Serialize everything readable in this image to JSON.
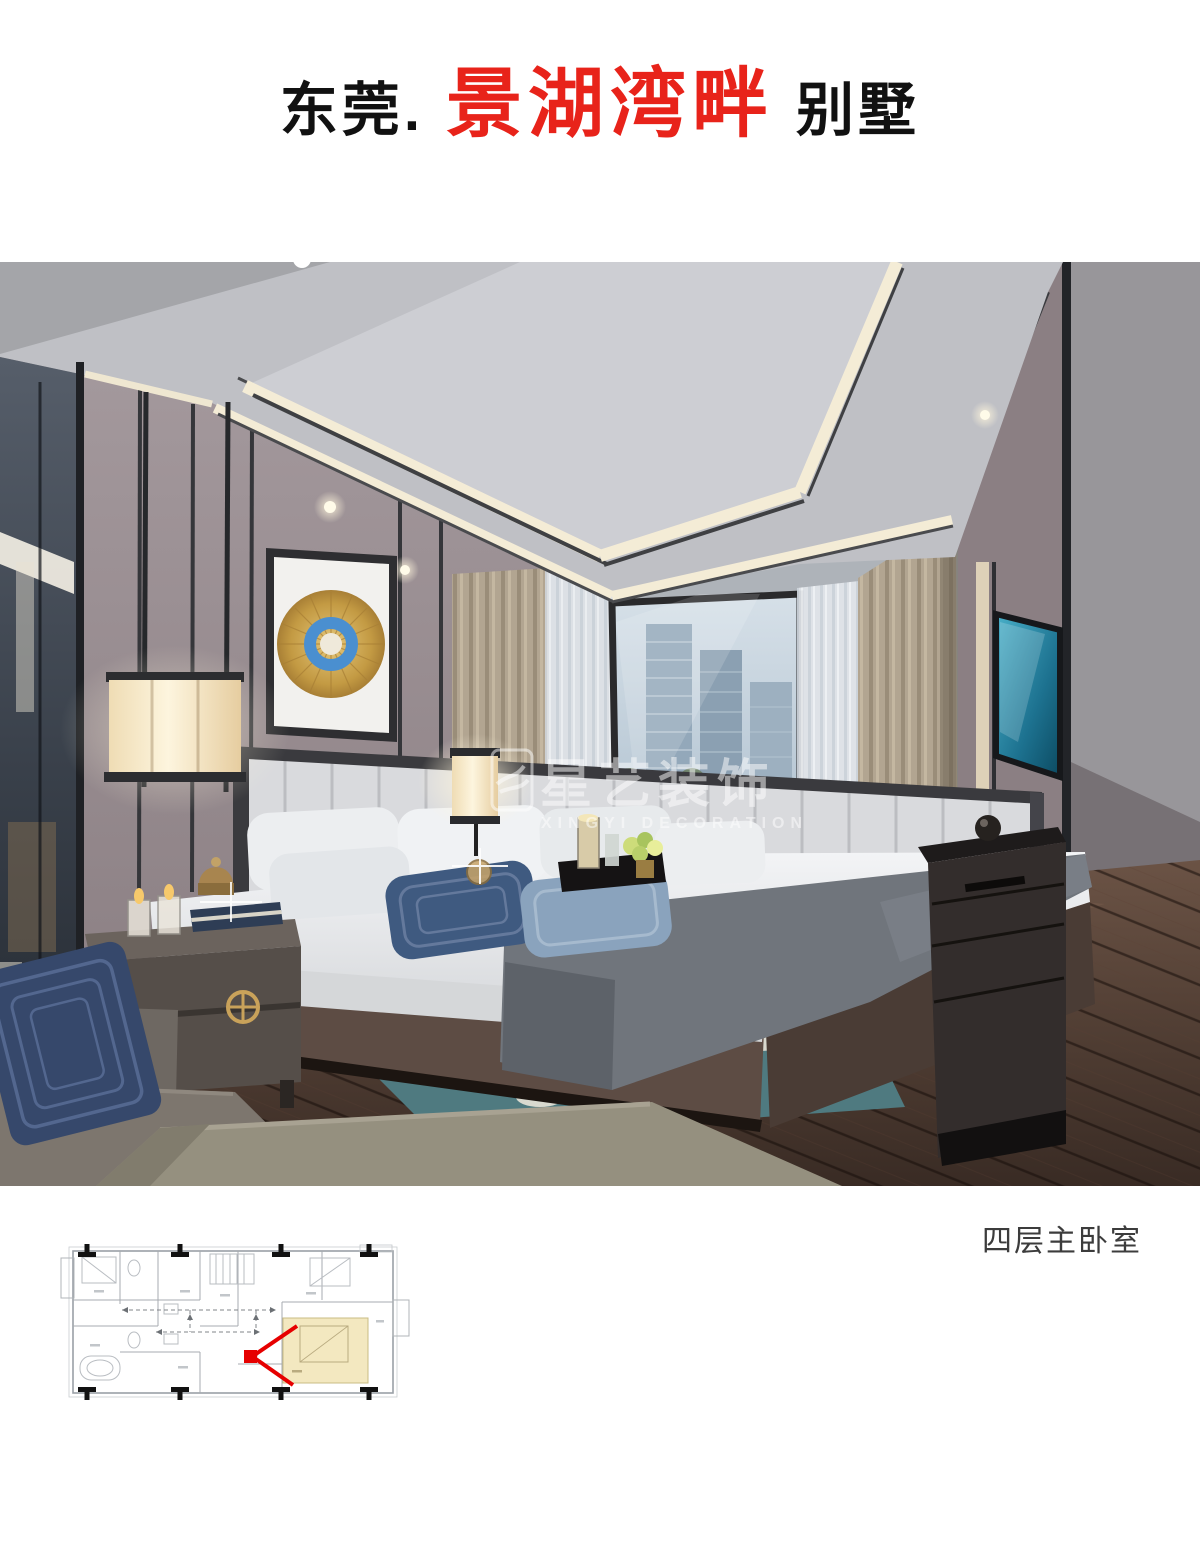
{
  "title": {
    "prefix": "东莞.",
    "highlight": "景湖湾畔",
    "suffix": "别墅",
    "highlight_color": "#e8231a",
    "text_color": "#111111"
  },
  "photo": {
    "description": "modern master bedroom interior design rendering",
    "watermark": {
      "cn": "星艺装饰",
      "en": "XINGYI DECORATION",
      "logo": "swallow-logo",
      "color": "#ffffff"
    }
  },
  "caption": {
    "text": "四层主卧室",
    "color": "#3c3c3c"
  },
  "floorplan": {
    "highlight_room": "master-bedroom",
    "highlight_color": "#f3e8c0",
    "arrow_color": "#e60000",
    "line_color": "#a7abb0",
    "marker_color": "#111111"
  },
  "scene_colors": {
    "ceiling": "#c2c3c7",
    "ceiling_tray": "#cdced3",
    "cove_light": "#f4ecd6",
    "wall": "#9a8d91",
    "trim_dark": "#35363a",
    "floor_wood": "#53413a",
    "curtain_beige": "#b2a591",
    "sheer": "#e2e6eb",
    "window_sky": "#c6d3dd",
    "city_building": "#8ba0b2",
    "tv_screen": "#2a7d95",
    "bedding_white": "#eef0f2",
    "throw_gray": "#6b7077",
    "pillow_navy": "#3f5a80",
    "pillow_blue": "#8aa3bd",
    "rug_teal": "#4f7a80",
    "lamp_glow": "#f7ecd0",
    "artwork_gold": "#c9a24a",
    "artwork_blue": "#4a8fd0",
    "furniture_wood": "#554e49",
    "brass": "#c9a25a"
  }
}
